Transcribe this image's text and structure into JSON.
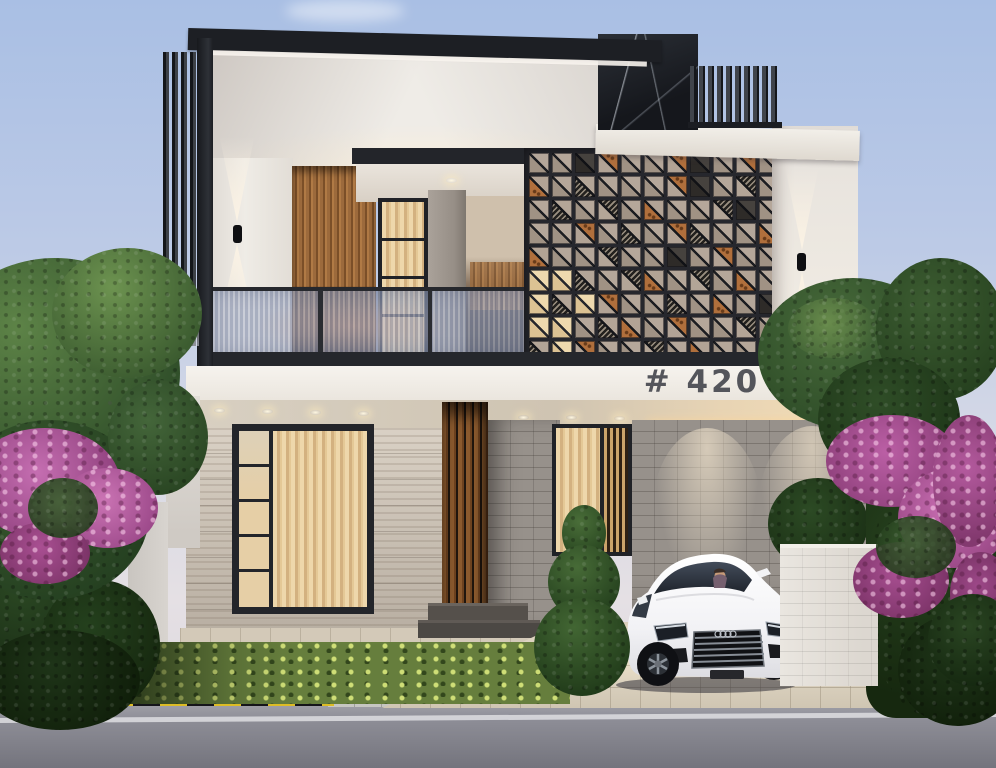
{
  "scene": {
    "type": "architectural exterior rendering",
    "time_of_day": "dusk",
    "house_number": "# 420",
    "vehicle": "white sedan with driver",
    "setting": "modern two-storey villa with driveway, hedge and flowering trees"
  },
  "colors": {
    "sky_top": "#a9bfe4",
    "sky_horizon": "#e5e0e4",
    "frame_dark": "#24262b",
    "wall_white": "#f1eee8",
    "wood_slat": "#9c6a3c",
    "curtain": "#ead2a4",
    "copper_panel": "#b06f3c",
    "screen_frame": "#26272d",
    "stone_wall": "#cdc3b6",
    "brick_wall": "#97918b",
    "glass_railing": "#a9b2c9",
    "road": "#8d8d96",
    "driveway": "#ddd3c0",
    "hedge_lit": "#a9bf58",
    "foliage": "#3e5c33",
    "flowers": "#bc62a6",
    "number_color": "#54555b",
    "hazard_yellow": "#ddbc25",
    "car_body": "#f4f4f6"
  },
  "screen_pattern": {
    "legend": {
      "g": "plain-diagonal",
      "c": "copper-lower",
      "C": "copper-upper",
      "p": "maze-lower",
      "P": "maze-upper",
      "d": "dark",
      "l": "lit"
    },
    "rows": [
      "ggdCggCdgCg",
      "cgpgggCdgPg",
      "gpgPgcggPdg",
      "ggCgpgCpggc",
      "cggPggdgCgg",
      "llpgPcgPgcg",
      "lplCggpgcgd",
      "llgpcgCggPg",
      "plCggPgcggC"
    ]
  }
}
